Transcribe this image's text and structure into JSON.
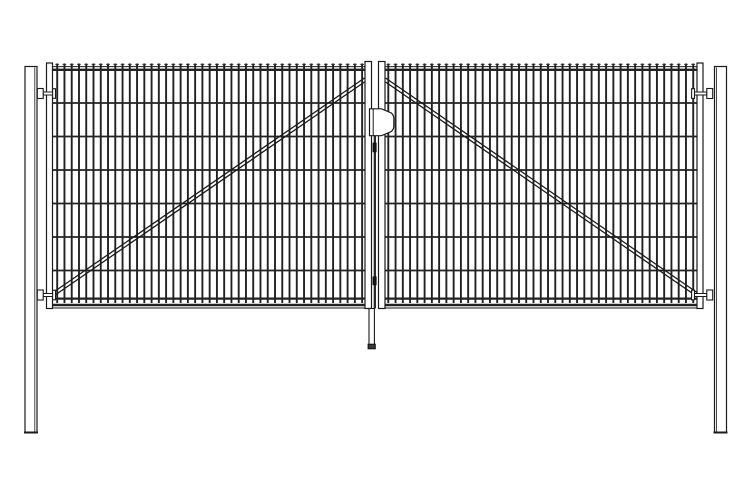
{
  "meta": {
    "title": "Double swing gate - technical line drawing, front elevation",
    "background": "#ffffff",
    "line_color": "#1b1b1b",
    "bar_color": "#222222",
    "dark_fill": "#2a2a2a"
  },
  "components": {
    "posts": 2,
    "gate_leaves": 2,
    "hinges": 4,
    "vertical_bars_per_leaf": 43,
    "horizontal_wires_per_leaf": 6,
    "diagonal_braces_per_leaf": 1,
    "lock": 1,
    "drop_rod": 1
  },
  "drawing": {
    "canvas": {
      "w": 750,
      "h": 500
    },
    "posts": [
      {
        "name": "left-post",
        "x": 25,
        "y": 66.5,
        "w": 12,
        "h": 366,
        "inner_x": 34.8
      },
      {
        "name": "right-post",
        "x": 714.5,
        "y": 66.5,
        "w": 12,
        "h": 366,
        "inner_x": 716.6
      }
    ],
    "leaves": [
      {
        "name": "left-leaf",
        "stiles": [
          {
            "x": 46.5,
            "y": 63,
            "w": 6,
            "h": 245.5
          },
          {
            "x": 365,
            "y": 61.5,
            "w": 6.5,
            "h": 247
          }
        ],
        "mesh": {
          "x1": 53,
          "x2": 365,
          "bar_x0": 57.2,
          "bar_dx": 7.26,
          "bar_n": 43
        },
        "brace": [
          [
            53,
            292.5,
            364.5,
            78
          ],
          [
            53,
            296.5,
            364.5,
            82
          ]
        ]
      },
      {
        "name": "right-leaf",
        "stiles": [
          {
            "x": 697,
            "y": 63,
            "w": 6,
            "h": 245.5
          },
          {
            "x": 378.5,
            "y": 61.5,
            "w": 6.5,
            "h": 247
          }
        ],
        "mesh": {
          "x1": 385,
          "x2": 697,
          "bar_x0": 388.3,
          "bar_dx": 7.26,
          "bar_n": 43
        },
        "brace": [
          [
            385.5,
            78,
            697,
            292.5
          ],
          [
            385.5,
            82,
            697,
            296.5
          ]
        ]
      }
    ],
    "mesh_common": {
      "bar_y1": 63.5,
      "bar_y2": 303,
      "bar_w": 1.9,
      "tick_y": 64.3,
      "tick_half": 1.9,
      "tick_w": 0.9,
      "top_thin_y": 66.6,
      "top_thin_w": 1,
      "top_thick_y": 69.8,
      "top_thick_w": 2.3,
      "wire_ys": [
        103,
        136.5,
        170,
        203.5,
        237,
        270.5
      ],
      "wire_w": 1.8,
      "bottom_thick_y": 298.6,
      "bottom_thick_w": 2.2,
      "band_y1": 305,
      "band_w1": 2.4,
      "band_y2": 308,
      "band_w2": 1
    },
    "hinges": {
      "cys": [
        93.5,
        295
      ],
      "left": {
        "block_x": 37.3,
        "pin_x": 43.2,
        "pin_len": 12,
        "head_x": 52.6
      },
      "right": {
        "block_x": 706.8,
        "pin_x": 694.5,
        "pin_len": 12.3,
        "head_x": 691.6
      },
      "block_w": 5.9,
      "block_h": 10,
      "pin_h": 3,
      "head_w": 2.9,
      "head_h": 9.6
    },
    "lock": {
      "path": "M369.5,108.8 H381.5 L391.3,113 Q393.8,115.2 393.8,118.3 V126.2 Q393.8,129.3 391.3,131.5 L381.5,135.7 H369.5 Z",
      "inner_x": 373.2,
      "y1": 108.8,
      "y2": 135.7
    },
    "drop_rod": {
      "gap_rod": {
        "x": 373.7,
        "y": 136,
        "w": 2.3,
        "h": 172.5
      },
      "guides": [
        {
          "x": 372.6,
          "y": 142.6,
          "w": 4,
          "h": 9.6
        },
        {
          "x": 372.6,
          "y": 276.4,
          "w": 4,
          "h": 8.8
        }
      ],
      "lower": {
        "x": 369,
        "y": 308.5,
        "w": 5.4,
        "h": 37
      },
      "foot": {
        "x": 368.1,
        "y": 344.2,
        "w": 7.2,
        "h": 4.6
      }
    }
  }
}
